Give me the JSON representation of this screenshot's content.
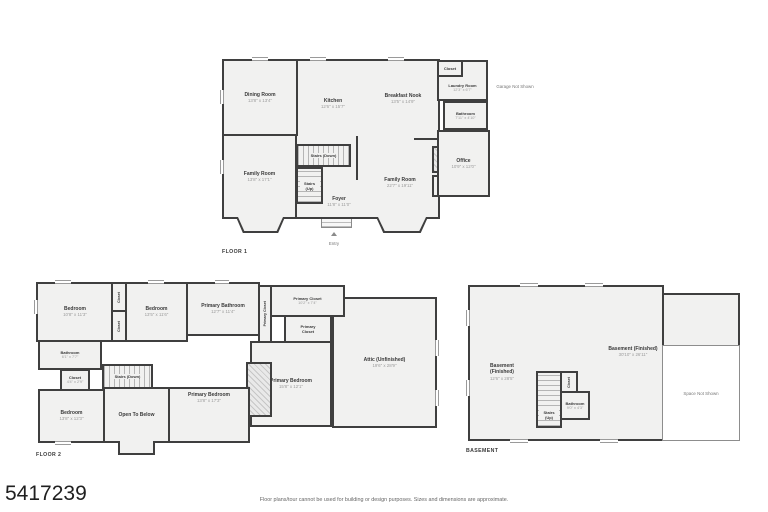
{
  "id_label": "5417239",
  "disclaimer": "Floor plans/tour cannot be used for building or design purposes. Sizes and dimensions are approximate.",
  "colors": {
    "wall": "#3f3f3f",
    "room_fill": "#f1f1f0",
    "name_text": "#3a3a3a",
    "dims_text": "#9b9b9b"
  },
  "floor1": {
    "title": "FLOOR 1",
    "dining": {
      "name": "Dining Room",
      "dims": "13'8\" x 13'4\""
    },
    "kitchen": {
      "name": "Kitchen",
      "dims": "12'6\" x 15'7\""
    },
    "breakfast": {
      "name": "Breakfast Nook",
      "dims": "13'5\" x 14'9\""
    },
    "closet_top": {
      "name": "Closet"
    },
    "laundry": {
      "name": "Laundry Room",
      "dims": "12'3\" x 6'7\""
    },
    "garage_note": "Garage Not Shown",
    "bathroom": {
      "name": "Bathroom",
      "dims": "7'11\" x 4'10\""
    },
    "office": {
      "name": "Office",
      "dims": "10'9\" x 12'0\""
    },
    "fireplace": {
      "name": "Fireplace"
    },
    "closet_side": {
      "name": "Closet"
    },
    "family_left": {
      "name": "Family Room",
      "dims": "13'8\" x 17'1\""
    },
    "family_right": {
      "name": "Family Room",
      "dims": "22'7\" x 19'11\""
    },
    "stairs_down": {
      "name": "Stairs (Down)"
    },
    "stairs_up": {
      "name": "Stairs (Up)"
    },
    "foyer": {
      "name": "Foyer",
      "dims": "11'8\" x 11'0\""
    },
    "entry": {
      "name": "Entry"
    }
  },
  "floor2": {
    "title": "FLOOR 2",
    "bedroom1": {
      "name": "Bedroom",
      "dims": "10'8\" x 11'3\""
    },
    "closet_a": {
      "name": "Closet"
    },
    "closet_b": {
      "name": "Closet"
    },
    "bedroom2": {
      "name": "Bedroom",
      "dims": "13'5\" x 11'6\""
    },
    "primary_bathroom": {
      "name": "Primary Bathroom",
      "dims": "12'7\" x 11'4\""
    },
    "primary_closet_strip": {
      "name": "Primary Closet"
    },
    "primary_closet_big": {
      "name": "Primary Closet",
      "dims": "10'2\" x 7'4\""
    },
    "primary_closet_small": {
      "name": "Primary Closet"
    },
    "bathroom": {
      "name": "Bathroom",
      "dims": "6'1\" x 7'7\""
    },
    "closet_c": {
      "name": "Closet",
      "dims": "4'4\" x 2'9\""
    },
    "stairs_down": {
      "name": "Stairs (Down)"
    },
    "bedroom3": {
      "name": "Bedroom",
      "dims": "13'8\" x 12'3\""
    },
    "open_to_below": {
      "name": "Open To Below"
    },
    "primary_bedroom": {
      "name": "Primary Bedroom",
      "dims": "13'8\" x 17'3\""
    },
    "primary_bedroom2": {
      "name": "Primary Bedroom",
      "dims": "15'8\" x 12'1\""
    },
    "attic": {
      "name": "Attic (Unfinished)",
      "dims": "19'6\" x 28'9\""
    }
  },
  "basement": {
    "title": "BASEMENT",
    "left": {
      "name": "Basement (Finished)",
      "dims": "12'6\" x 28'5\""
    },
    "main": {
      "name": "Basement (Finished)",
      "dims": "30'10\" x 26'11\""
    },
    "stairs_up": {
      "name": "Stairs (Up)"
    },
    "closet": {
      "name": "Closet"
    },
    "bathroom": {
      "name": "Bathroom",
      "dims": "9'0\" x 4'3\""
    },
    "space_note": "Space Not Shown"
  }
}
